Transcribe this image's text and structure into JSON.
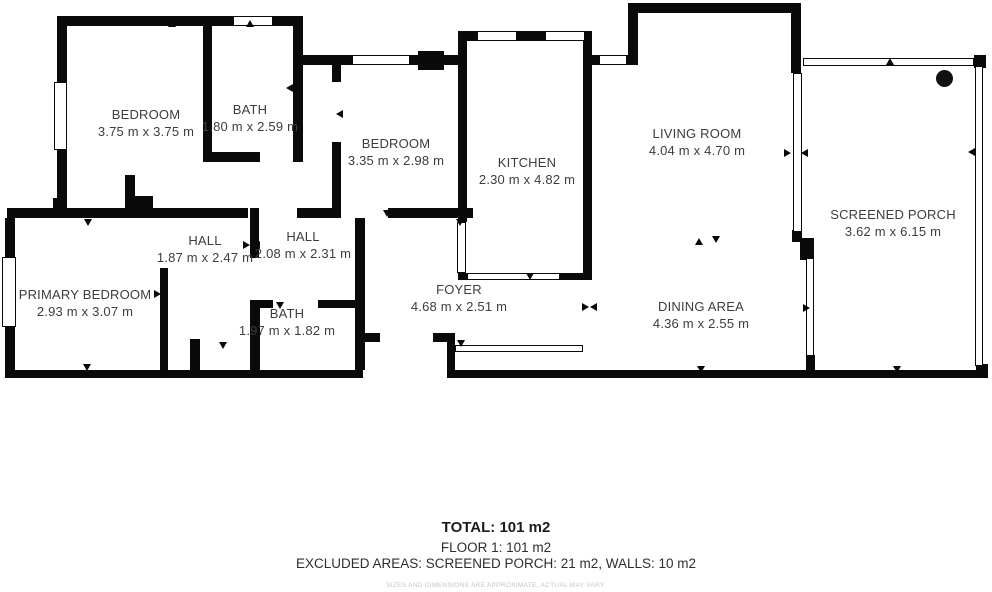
{
  "title": "Floor plan — Floor 1",
  "colors": {
    "wall": "#0a0a0a",
    "background": "#ffffff",
    "room_label": "#3d3d3d",
    "disclaimer": "#c4c4c4"
  },
  "icons": {
    "door_marker": "door-swing-arrow-icon",
    "scan_point": "scan-point-icon",
    "window": "window-symbol",
    "screen_wall": "screen-wall-symbol"
  },
  "rooms": [
    {
      "name": "BEDROOM",
      "dims": "3.75 m x 3.75 m"
    },
    {
      "name": "BATH",
      "dims": "1.80 m x 2.59 m"
    },
    {
      "name": "BEDROOM",
      "dims": "3.35 m x 2.98 m"
    },
    {
      "name": "KITCHEN",
      "dims": "2.30 m x 4.82 m"
    },
    {
      "name": "LIVING ROOM",
      "dims": "4.04 m x 4.70 m"
    },
    {
      "name": "SCREENED PORCH",
      "dims": "3.62 m x 6.15 m"
    },
    {
      "name": "HALL",
      "dims": "1.87 m x 2.47 m"
    },
    {
      "name": "HALL",
      "dims": "2.08 m x 2.31 m"
    },
    {
      "name": "PRIMARY BEDROOM",
      "dims": "2.93 m x 3.07 m"
    },
    {
      "name": "BATH",
      "dims": "1.97 m x 1.82 m"
    },
    {
      "name": "FOYER",
      "dims": "4.68 m x 2.51 m"
    },
    {
      "name": "DINING AREA",
      "dims": "4.36 m x 2.55 m"
    }
  ],
  "footer": {
    "total": "TOTAL: 101 m2",
    "floor": "FLOOR 1: 101 m2",
    "excluded": "EXCLUDED AREAS: SCREENED PORCH: 21 m2, WALLS: 10 m2",
    "disclaimer": "SIZES AND DIMENSIONS ARE APPROXIMATE, ACTUAL MAY VARY."
  }
}
